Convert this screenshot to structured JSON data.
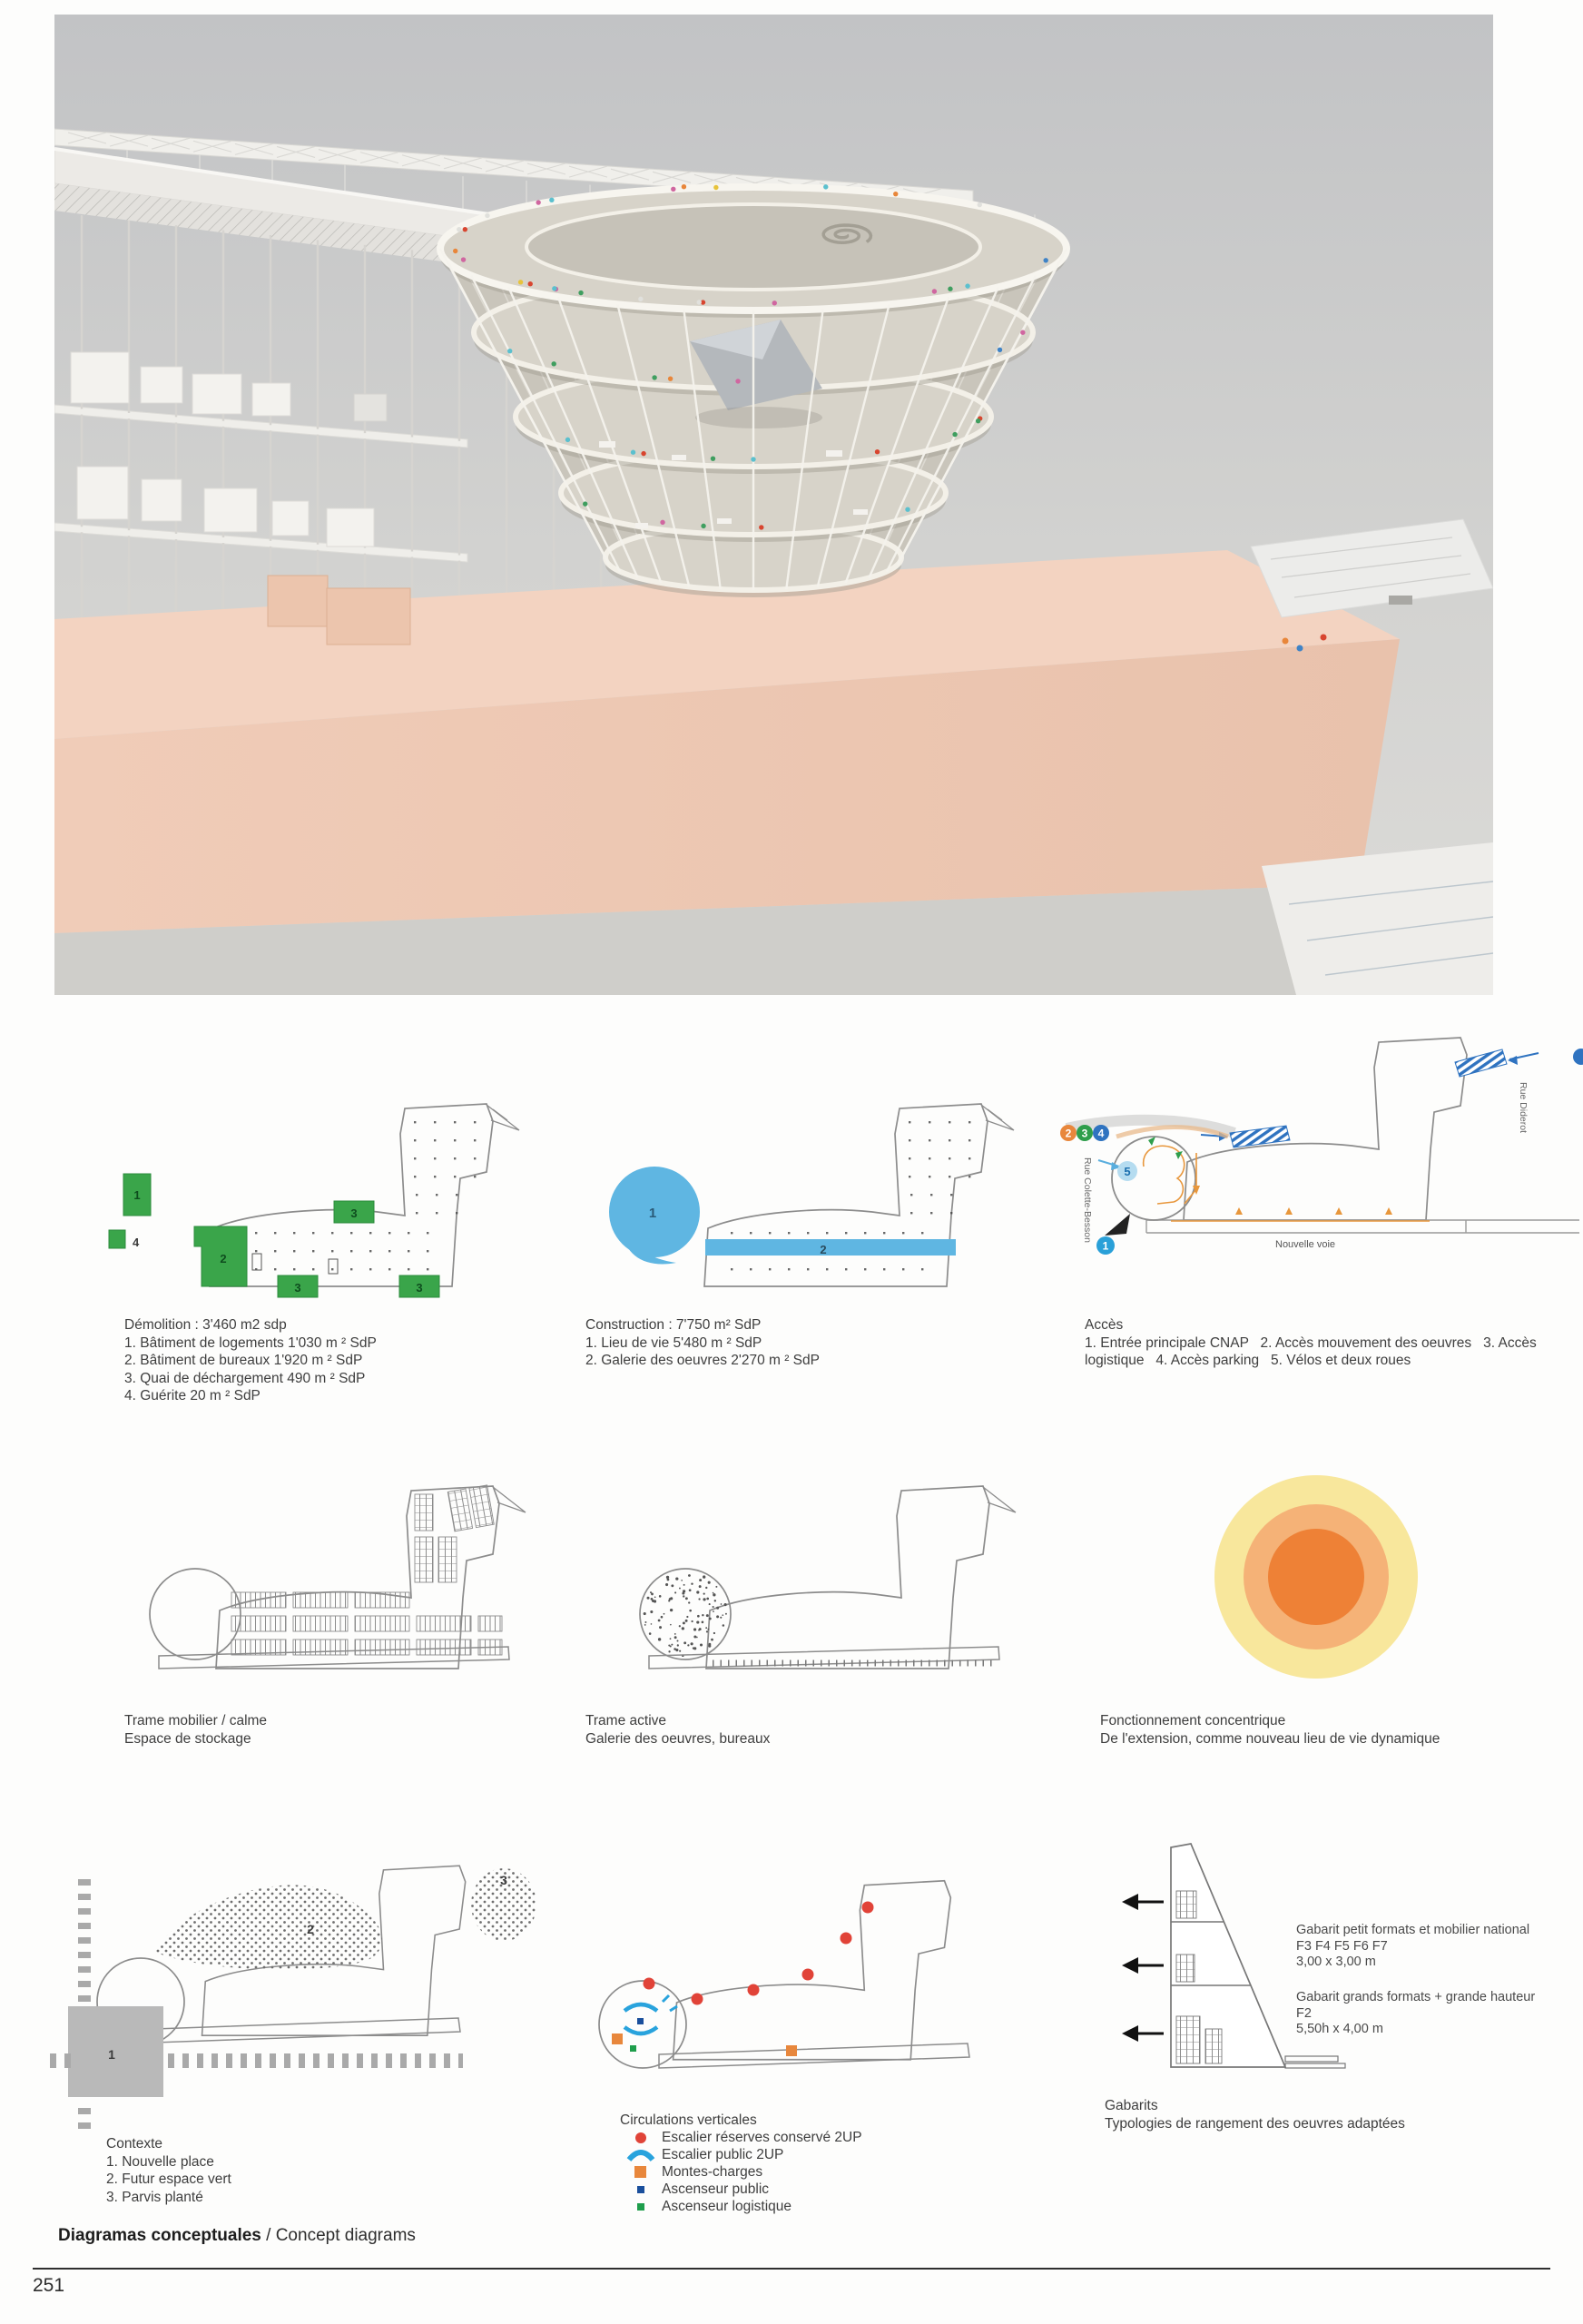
{
  "page": {
    "number": "251"
  },
  "footer": {
    "title_bold": "Diagramas conceptuales",
    "title_rest": " / Concept diagrams"
  },
  "row1": {
    "demolition": {
      "title": "Démolition  : 3'460 m2 sdp",
      "items": [
        "1. Bâtiment de logements 1'030 m  ² SdP",
        "2. Bâtiment de bureaux 1'920 m  ² SdP",
        "3. Quai de déchargement 490 m  ² SdP",
        "4. Guérite 20 m ² SdP"
      ],
      "labels": [
        "1",
        "2",
        "3",
        "3",
        "3",
        "4"
      ]
    },
    "construction": {
      "title": "Construction  : 7'750 m² SdP",
      "items": [
        "1. Lieu de vie 5'480 m  ² SdP",
        "2. Galerie des oeuvres 2'270 m  ² SdP"
      ],
      "labels": [
        "1",
        "2"
      ]
    },
    "acces": {
      "title": "Accès",
      "body": "1. Entrée principale CNAP   2. Accès mouvement des oeuvres   3. Accès logistique   4. Accès parking   5. Vélos et deux roues",
      "streets": {
        "left": "Rue Colette-Besson",
        "right": "Rue Diderot",
        "bottom": "Nouvelle voie"
      },
      "badges": [
        "2",
        "3",
        "4",
        "5",
        "1"
      ]
    }
  },
  "row2": {
    "trame_mobilier": {
      "title": "Trame mobilier / calme",
      "body": "Espace de stockage"
    },
    "trame_active": {
      "title": "Trame active",
      "body": "Galerie des oeuvres, bureaux"
    },
    "concentrique": {
      "title": "Fonctionnement concentrique",
      "body": "De l'extension, comme nouveau lieu de vie dynamique"
    }
  },
  "row3": {
    "contexte": {
      "title": "Contexte",
      "items": [
        "1. Nouvelle place",
        "2. Futur espace vert",
        "3. Parvis planté"
      ],
      "labels": [
        "1",
        "2",
        "3"
      ]
    },
    "circulations": {
      "title": "Circulations verticales",
      "legend": [
        {
          "label": "Escalier réserves conservé 2UP",
          "color": "#e04438"
        },
        {
          "label": "Escalier public 2UP",
          "color": "#29a3dd"
        },
        {
          "label": "Montes-charges",
          "color": "#e8873c"
        },
        {
          "label": "Ascenseur public",
          "color": "#1a4f9c"
        },
        {
          "label": "Ascenseur logistique",
          "color": "#1f9e4c"
        }
      ]
    },
    "gabarits": {
      "title": "Gabarits",
      "body": "Typologies de rangement des oeuvres adaptées",
      "label_small": [
        "Gabarit petit formats et mobilier national",
        "F3 F4 F5 F6 F7",
        "3,00 x 3,00 m"
      ],
      "label_large": [
        "Gabarit grands formats + grande hauteur",
        "F2",
        "5,50h x 4,00 m"
      ]
    }
  },
  "colors": {
    "demolition_green": "#3aa54a",
    "construction_blue": "#5fb6e2",
    "accent_orange": "#e8873c",
    "concentric": [
      "#f8e79c",
      "#f5b277",
      "#ee8136"
    ]
  }
}
